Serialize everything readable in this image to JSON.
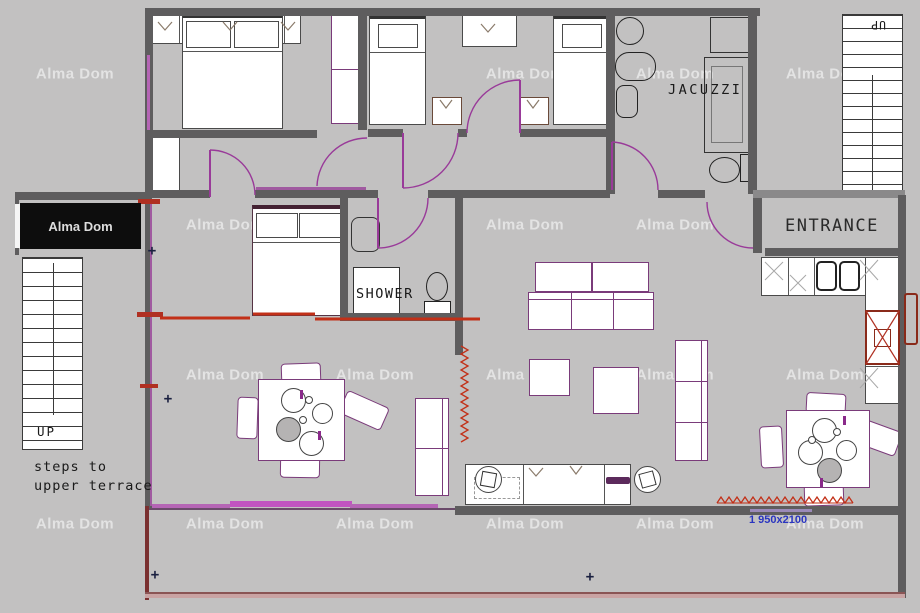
{
  "title": "Apartment floor plan with terrace",
  "labels": {
    "jacuzzi": "JACUZZI",
    "shower": "SHOWER",
    "entrance": "ENTRANCE",
    "up_left": "UP",
    "up_right": "UP",
    "steps_line1": "steps to",
    "steps_line2": "upper terrace",
    "dimension": "1 950x2100",
    "brand_box": "Alma Dom"
  },
  "watermark": {
    "text": "Alma Dom",
    "positions": [
      [
        75,
        74
      ],
      [
        525,
        74
      ],
      [
        675,
        74
      ],
      [
        825,
        74
      ],
      [
        225,
        225
      ],
      [
        525,
        225
      ],
      [
        675,
        225
      ],
      [
        225,
        375
      ],
      [
        375,
        375
      ],
      [
        525,
        375
      ],
      [
        675,
        375
      ],
      [
        825,
        375
      ],
      [
        75,
        524
      ],
      [
        225,
        524
      ],
      [
        375,
        524
      ],
      [
        525,
        524
      ],
      [
        675,
        524
      ],
      [
        825,
        524
      ]
    ]
  },
  "marks": {
    "plus": {
      "glyph": "+",
      "positions": [
        [
          168,
          399
        ],
        [
          152,
          251
        ],
        [
          155,
          575
        ],
        [
          590,
          577
        ]
      ]
    }
  },
  "colors": {
    "floor": "#c2c1c1",
    "wall": "#5e5d5e",
    "door_arc": "#993a99",
    "window_magenta": "#b565b5",
    "heating_red": "#c23018",
    "terrace_edge": "#c9a3a3",
    "dimension_text": "#2a35c0",
    "brand_box_bg": "#0d0d0d",
    "watermark": "rgba(255,255,255,0.55)"
  }
}
